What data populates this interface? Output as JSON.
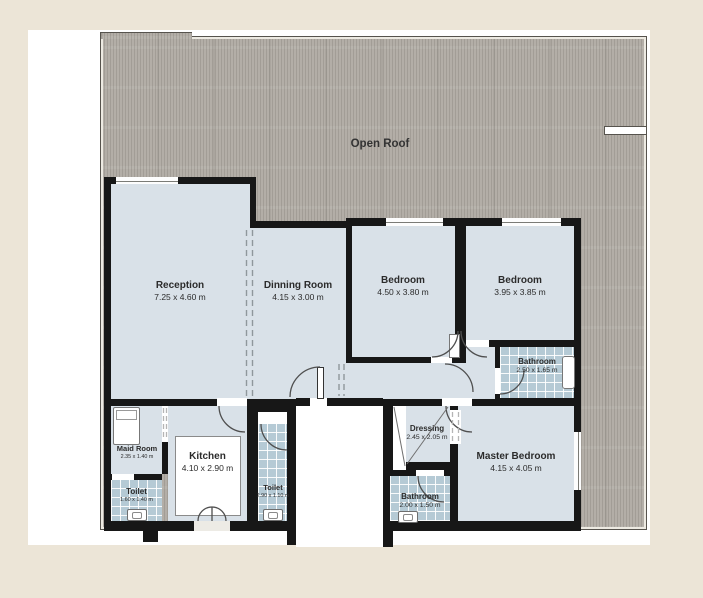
{
  "plan": {
    "open_roof_label": "Open Roof",
    "rooms": {
      "reception": {
        "name": "Reception",
        "dims": "7.25 x 4.60 m"
      },
      "dinning_room": {
        "name": "Dinning Room",
        "dims": "4.15 x 3.00 m"
      },
      "bedroom_1": {
        "name": "Bedroom",
        "dims": "4.50 x 3.80 m"
      },
      "bedroom_2": {
        "name": "Bedroom",
        "dims": "3.95 x 3.85 m"
      },
      "bathroom_1": {
        "name": "Bathroom",
        "dims": "2.50 x 1.65 m"
      },
      "dressing": {
        "name": "Dressing",
        "dims": "2.45 x 2.05 m"
      },
      "master_bedroom": {
        "name": "Master Bedroom",
        "dims": "4.15 x 4.05 m"
      },
      "bathroom_2": {
        "name": "Bathroom",
        "dims": "2.00 x 1.50 m"
      },
      "toilet_service": {
        "name": "Toilet",
        "dims": "2.90 x 1.10 m"
      },
      "kitchen": {
        "name": "Kitchen",
        "dims": "4.10 x 2.90 m"
      },
      "maid_room": {
        "name": "Maid Room",
        "dims": "2.35 x 1.40 m"
      },
      "toilet_maid": {
        "name": "Toilet",
        "dims": "1.60 x 1.40 m"
      }
    },
    "colors": {
      "page_background": "#ece5d7",
      "sheet": "#ffffff",
      "roof_fill": "#b3aea7",
      "room_floor": "#d9e1e8",
      "tile_floor": "#b5cad5",
      "wall": "#171717",
      "label_text": "#2b2b2b"
    }
  }
}
